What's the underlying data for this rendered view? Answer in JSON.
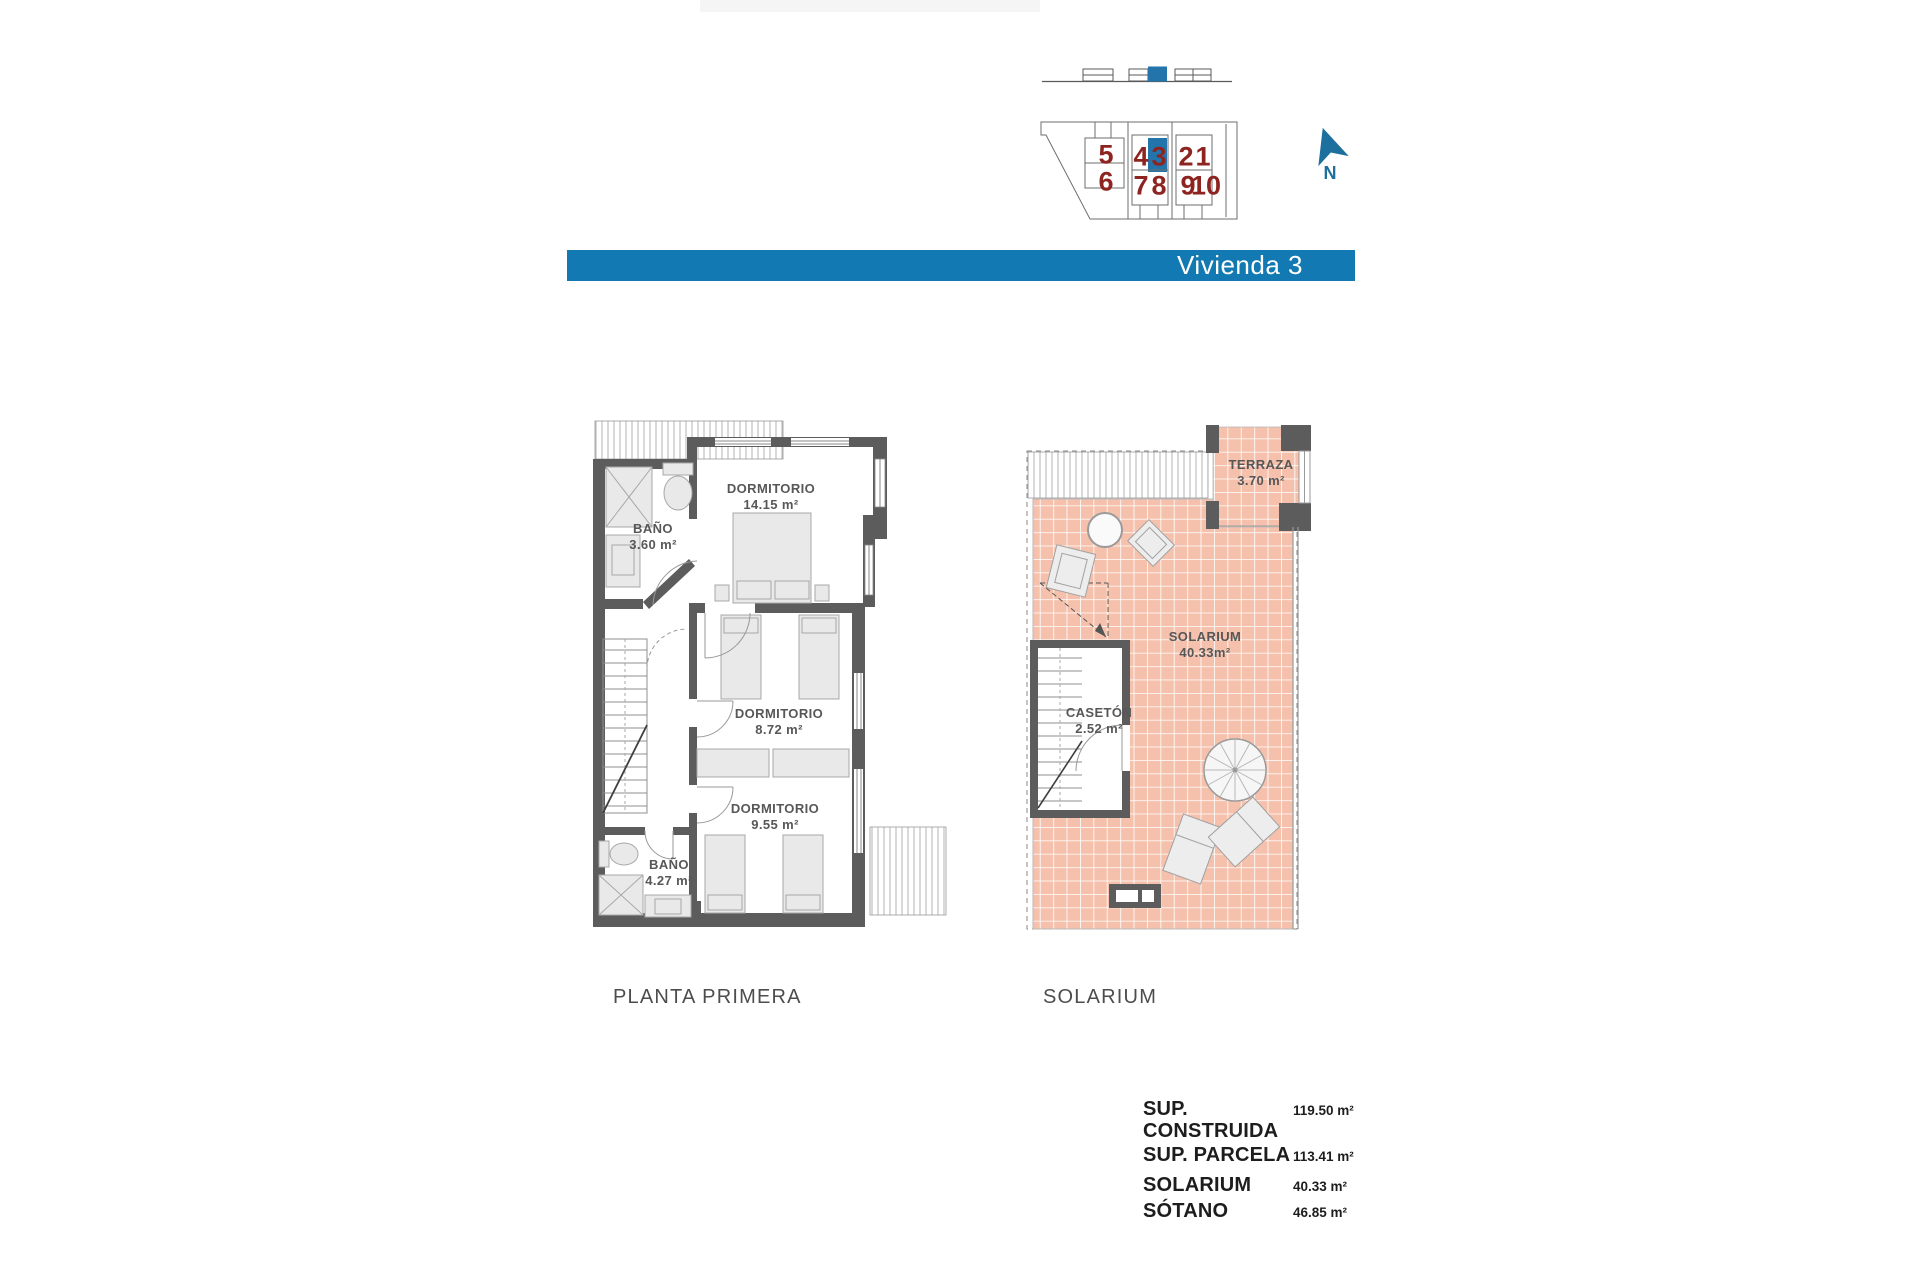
{
  "banner": {
    "title": "Vivienda 3"
  },
  "site_locator": {
    "north_label": "N",
    "highlighted_unit": "3",
    "units": [
      {
        "label": "5",
        "highlighted": false
      },
      {
        "label": "6",
        "highlighted": false
      },
      {
        "label": "4",
        "highlighted": false
      },
      {
        "label": "3",
        "highlighted": true
      },
      {
        "label": "7",
        "highlighted": false
      },
      {
        "label": "8",
        "highlighted": false
      },
      {
        "label": "2",
        "highlighted": false
      },
      {
        "label": "1",
        "highlighted": false
      },
      {
        "label": "9",
        "highlighted": false
      },
      {
        "label": "10",
        "highlighted": false
      }
    ]
  },
  "plans": {
    "planta_primera": {
      "caption": "PLANTA PRIMERA",
      "rooms": [
        {
          "name": "BAÑO",
          "area": "3.60 m²"
        },
        {
          "name": "DORMITORIO",
          "area": "14.15 m²"
        },
        {
          "name": "DORMITORIO",
          "area": "8.72 m²"
        },
        {
          "name": "DORMITORIO",
          "area": "9.55 m²"
        },
        {
          "name": "BAÑO",
          "area": "4.27 m²"
        }
      ]
    },
    "solarium": {
      "caption": "SOLARIUM",
      "rooms": [
        {
          "name": "TERRAZA",
          "area": "3.70 m²"
        },
        {
          "name": "SOLARIUM",
          "area": "40.33m²"
        },
        {
          "name": "CASETÓN",
          "area": "2.52 m²"
        }
      ]
    }
  },
  "summary": {
    "rows": [
      {
        "label": "SUP. CONSTRUIDA",
        "value": "119.50 m²"
      },
      {
        "label": "SUP. PARCELA",
        "value": "113.41 m²"
      },
      {
        "label": "SOLARIUM",
        "value": "40.33 m²"
      },
      {
        "label": "SÓTANO",
        "value": "46.85 m²"
      }
    ]
  },
  "colors": {
    "banner_blue": "#1279b2",
    "highlight_blue": "#2274ab",
    "north_arrow_blue": "#1d6f9e",
    "unit_number_red": "#8e2420",
    "wall_grey": "#5c5c5c",
    "tile_pink": "#f5c1ac"
  }
}
